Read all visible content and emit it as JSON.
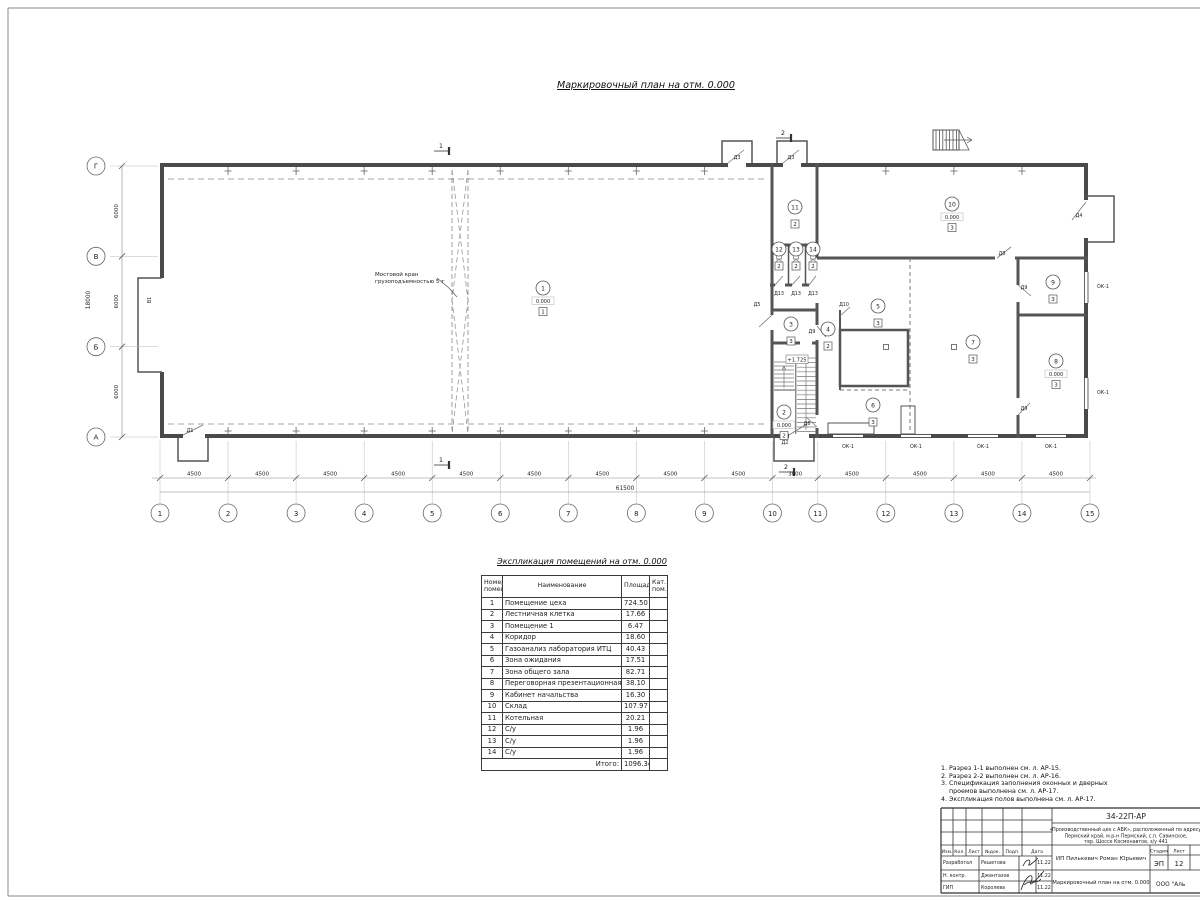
{
  "page": {
    "plan_title": "Маркировочный план  на отм. 0.000"
  },
  "plan": {
    "axes_bottom": [
      "1",
      "2",
      "3",
      "4",
      "5",
      "6",
      "7",
      "8",
      "9",
      "10",
      "11",
      "12",
      "13",
      "14",
      "15"
    ],
    "axes_left": [
      "Г",
      "В",
      "Б",
      "А"
    ],
    "spans_bottom": [
      4500,
      4500,
      4500,
      4500,
      4500,
      4500,
      4500,
      4500,
      4500,
      3000,
      4500,
      4500,
      4500,
      4500
    ],
    "dim_labels_bottom": [
      "4500",
      "4500",
      "4500",
      "4500",
      "4500",
      "4500",
      "4500",
      "4500",
      "4500",
      "3000",
      "4500",
      "4500",
      "4500",
      "4500"
    ],
    "dim_total_bottom": "61500",
    "spans_left": [
      6000,
      6000,
      6000
    ],
    "dim_labels_left": [
      "6000",
      "6000",
      "6000"
    ],
    "dim_total_left": "18000",
    "crane_label_line1": "Мостовой кран",
    "crane_label_line2": "грузоподъемностью 5 т",
    "stair_elevation": "+1.725",
    "section_mark_1": "1",
    "section_mark_2": "2",
    "doors": {
      "gate": "В1",
      "d1": "Д1",
      "d2": "Д2",
      "d3": "Д3",
      "d4": "Д4",
      "d5": "Д5",
      "d6": "Д6",
      "d8": "Д8",
      "d9": "Д9",
      "d10": "Д10",
      "d13": "Д13",
      "window": "ОК-1"
    },
    "room_tags": [
      {
        "num": "1",
        "elev": "0.000",
        "floor": "1"
      },
      {
        "num": "2",
        "elev": "0.000",
        "floor": "2"
      },
      {
        "num": "3",
        "floor": "3"
      },
      {
        "num": "4",
        "floor": "2"
      },
      {
        "num": "5",
        "floor": "3"
      },
      {
        "num": "6",
        "floor": "3"
      },
      {
        "num": "7",
        "floor": "3"
      },
      {
        "num": "8",
        "elev": "0.000",
        "floor": "3"
      },
      {
        "num": "9",
        "floor": "3"
      },
      {
        "num": "10",
        "elev": "0.000",
        "floor": "3"
      },
      {
        "num": "11",
        "floor": "2"
      },
      {
        "num": "12",
        "floor": "2"
      },
      {
        "num": "13",
        "floor": "2"
      },
      {
        "num": "14",
        "floor": "2"
      }
    ]
  },
  "table": {
    "title": "Экспликация помещений на отм. 0.000",
    "headers": {
      "num": "Номер\nпомещ.",
      "name": "Наименование",
      "area": "Площадь",
      "cat": "Кат.\nпом."
    },
    "rows": [
      [
        "1",
        "Помещение цеха",
        "724.50"
      ],
      [
        "2",
        "Лестничная клетка",
        "17.66"
      ],
      [
        "3",
        "Помещение 1",
        "6.47"
      ],
      [
        "4",
        "Коридор",
        "18.60"
      ],
      [
        "5",
        "Газоанализ лаборатория ИТЦ",
        "40.43"
      ],
      [
        "6",
        "Зона ожидания",
        "17.51"
      ],
      [
        "7",
        "Зона общего зала",
        "82.71"
      ],
      [
        "8",
        "Переговорная презентационная",
        "38.10"
      ],
      [
        "9",
        "Кабинет начальства",
        "16.30"
      ],
      [
        "10",
        "Склад",
        "107.97"
      ],
      [
        "11",
        "Котельная",
        "20.21"
      ],
      [
        "12",
        "С/у",
        "1.96"
      ],
      [
        "13",
        "С/у",
        "1.96"
      ],
      [
        "14",
        "С/у",
        "1.96"
      ]
    ],
    "total_label": "Итого:",
    "total_value": "1096.34"
  },
  "notes": {
    "lines": [
      "1. Разрез 1-1 выполнен см. л. АР-15.",
      "2. Разрез 2-2 выполнен см. л. АР-16.",
      "3. Спецификация заполнения оконных и дверных",
      "    проемов выполнена см. л. АР-17.",
      "4. Экспликация полов выполнена см. л. АР-17."
    ]
  },
  "title_block": {
    "doc_number": "34-22П-АР",
    "project_line1": "«Производственный цех с АБК», расположенный по адресу:",
    "project_line2": "Пермский край, м.р-н Пермский, с.п. Савинское,",
    "project_line3": "тер. Шоссе Космонавтов, з/у 441",
    "cols": [
      "Изм.",
      "Кол.",
      "Лист",
      "№док.",
      "Подп.",
      "Дата"
    ],
    "row1_role": "Разработал",
    "row1_name": "Решетова",
    "row1_date": "11.22",
    "row2_role": "Н. контр.",
    "row2_name": "Джентазов",
    "row2_date": "11.22",
    "row3_role": "ГИП",
    "row3_name": "Королева",
    "row3_date": "11.22",
    "client": "ИП Пилькевич Роман Юрьевич",
    "stage_label": "Стадия",
    "sheet_label": "Лист",
    "stage": "ЭП",
    "sheet_number": "12",
    "drawing_title": "Маркировочный план на отм. 0.000",
    "company": "ООО \"Аль"
  }
}
